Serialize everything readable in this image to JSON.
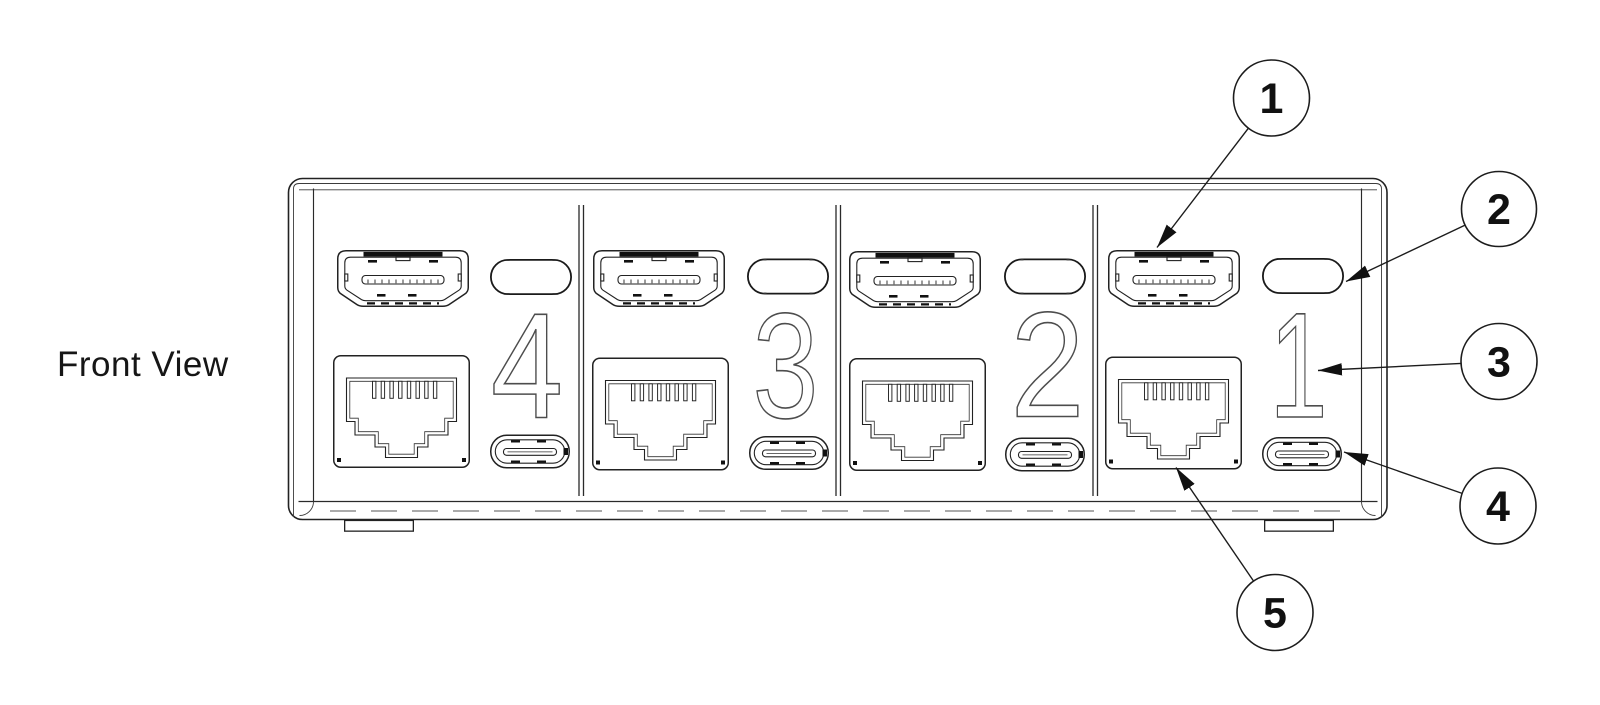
{
  "diagram": {
    "view_label": "Front View",
    "sections": [
      {
        "number": "4",
        "ports": [
          "hdmi-port",
          "selection-button",
          "ethernet-port",
          "usb-c-port"
        ]
      },
      {
        "number": "3",
        "ports": [
          "hdmi-port",
          "selection-button",
          "ethernet-port",
          "usb-c-port"
        ]
      },
      {
        "number": "2",
        "ports": [
          "hdmi-port",
          "selection-button",
          "ethernet-port",
          "usb-c-port"
        ]
      },
      {
        "number": "1",
        "ports": [
          "hdmi-port",
          "selection-button",
          "ethernet-port",
          "usb-c-port"
        ]
      }
    ],
    "callouts": [
      {
        "number": "1",
        "points_to": "hdmi-port"
      },
      {
        "number": "2",
        "points_to": "selection-button"
      },
      {
        "number": "3",
        "points_to": "panel-number"
      },
      {
        "number": "4",
        "points_to": "usb-c-port"
      },
      {
        "number": "5",
        "points_to": "ethernet-port"
      }
    ],
    "colors": {
      "background": "#ffffff",
      "line": "#1f1f1f",
      "panel_number_outline": "#4d4d4d"
    }
  }
}
